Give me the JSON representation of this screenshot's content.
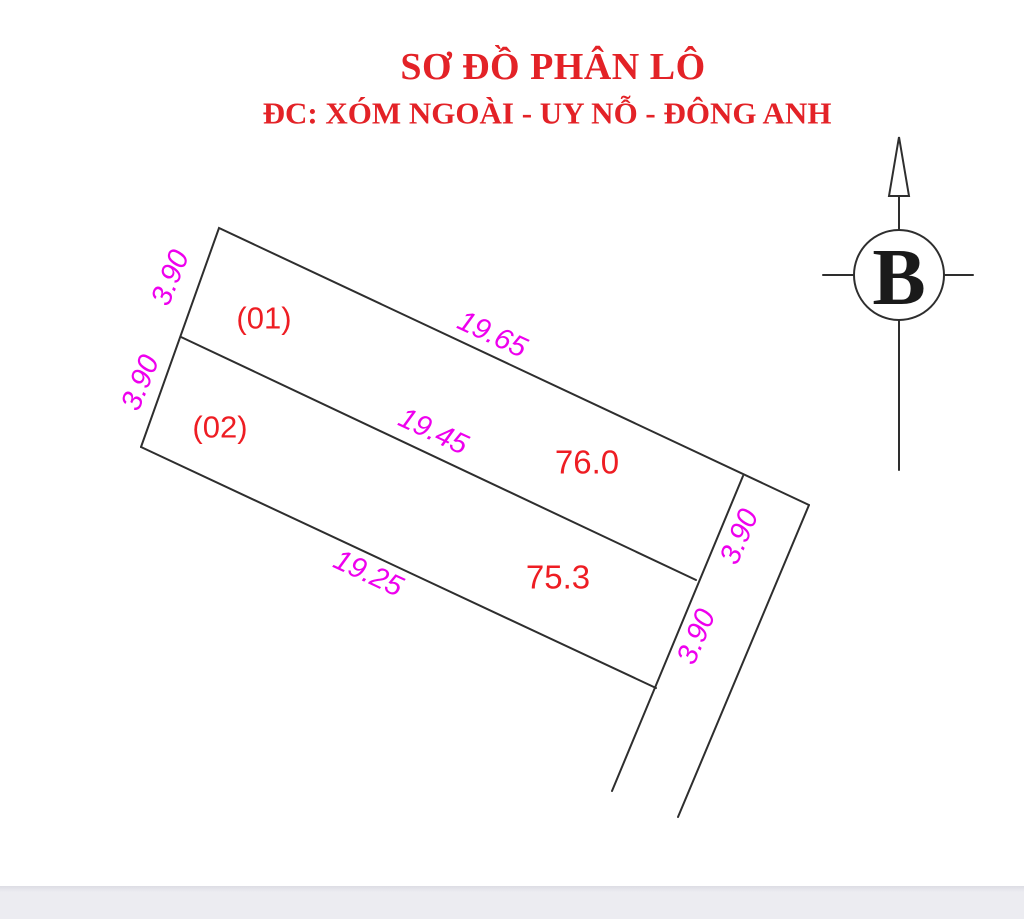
{
  "header": {
    "title": "SƠ ĐỒ PHÂN LÔ",
    "subtitle": "ĐC: XÓM NGOÀI - UY NỖ - ĐÔNG ANH"
  },
  "diagram": {
    "plots": [
      {
        "id": "(01)",
        "area": "76.0",
        "dims": {
          "front": "19.65",
          "left": "3.90",
          "right": "3.90"
        }
      },
      {
        "id": "(02)",
        "area": "75.3",
        "dims": {
          "front": "19.45",
          "back": "19.25",
          "left": "3.90",
          "right": "3.90"
        }
      }
    ]
  },
  "compass": {
    "label": "B"
  },
  "colors": {
    "background": "#ffffff",
    "title_red": "#e32227",
    "label_red": "#ee1d23",
    "dim_magenta": "#ee00ee",
    "line_dark": "#2e2e2e",
    "footer_gray": "#ececf1"
  }
}
